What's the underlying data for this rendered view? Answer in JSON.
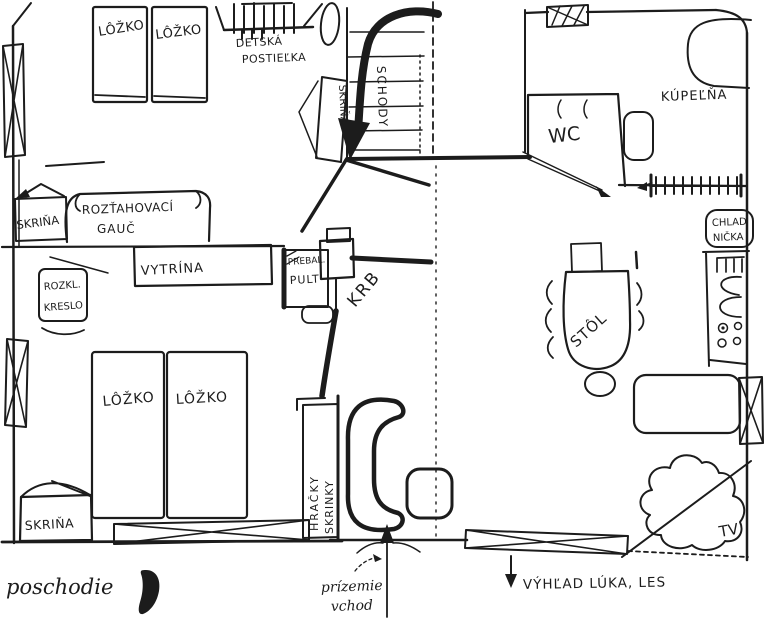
{
  "colors": {
    "ink": "#1c1c1c",
    "paper": "#ffffff"
  },
  "plan": {
    "upper_bedroom": {
      "bed1": "LÔŽKO",
      "bed2": "LÔŽKO",
      "crib_line1": "DETSKÁ",
      "crib_line2": "POSTIEĽKA"
    },
    "stairs": {
      "label": "SCHODY",
      "closet": "SKRIŇA"
    },
    "upper_living": {
      "wardrobe": "SKRIŇA",
      "couch_line1": "ROZŤAHOVACÍ",
      "couch_line2": "GAUČ",
      "display_cabinet": "VYTRÍNA",
      "armchair_line1": "ROZKL.",
      "armchair_line2": "KRESLO",
      "desk_line1": "PREBAĽ.",
      "desk_line2": "PULT",
      "fireplace": "KRB"
    },
    "lower_bedroom": {
      "bed1": "LÔŽKO",
      "bed2": "LÔŽKO",
      "wardrobe": "SKRIŇA",
      "toy_cabinet_line1": "SKRINKY",
      "toy_cabinet_line2": "HRAČKY"
    },
    "bathroom": {
      "label": "KÚPEĽŇA"
    },
    "wc": {
      "label": "WC"
    },
    "kitchen": {
      "fridge_line1": "CHLAD",
      "fridge_line2": "NIČKA",
      "table": "STÔL"
    },
    "lounge": {
      "tv": "TV"
    },
    "annotations": {
      "floor_label": "poschodie",
      "entrance_line1": "prízemie",
      "entrance_line2": "vchod",
      "view_label": "VÝHĽAD LÚKA, LES"
    }
  }
}
